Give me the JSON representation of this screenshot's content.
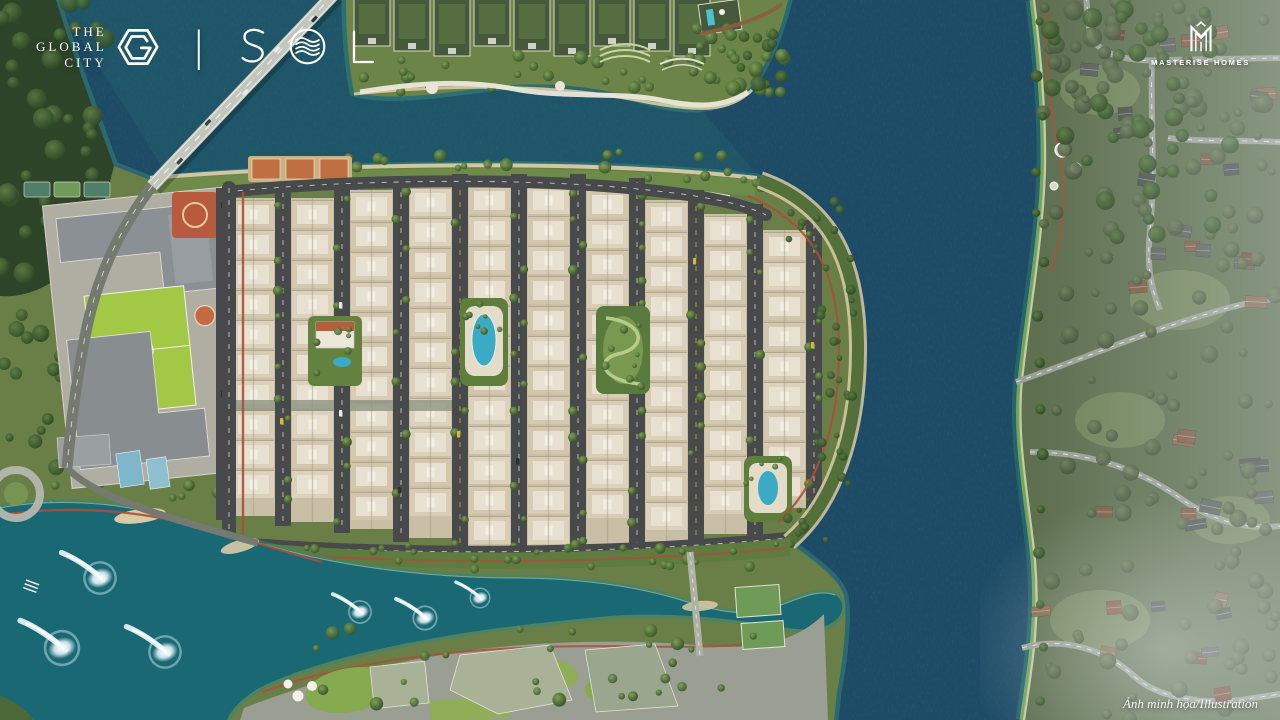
{
  "page": {
    "type": "aerial-masterplan-render"
  },
  "branding": {
    "global_city": {
      "lines": [
        "THE",
        "GLOBAL",
        "CITY"
      ],
      "icon": "hexagon-g-logo-icon"
    },
    "divider": "|",
    "project": {
      "name": "SOLA",
      "icon": "sola-wave-o-icon"
    },
    "developer": {
      "name": "MASTERISE HOMES",
      "icon": "masterise-m-monogram-icon"
    }
  },
  "watermark": {
    "text": "Ảnh minh họa/Illustration"
  },
  "palette": {
    "river_deep": "#1d4b66",
    "lake_teal": "#1a6873",
    "shore_teal": "#3f9480",
    "land_green": "#6a7f47",
    "forest_dark": "#2e4428",
    "neighborhood_green": "#5e7050",
    "road_asphalt": "#47494b",
    "suburb_road": "#99a198",
    "townhouse_cream": "#d8cdb4",
    "roof_white": "#e8e1d1",
    "path_red": "#a85038",
    "sand": "#d9cba6",
    "sports_field": "#a3c845",
    "pool_blue": "#3aabc4",
    "logo_white": "#ffffff"
  }
}
